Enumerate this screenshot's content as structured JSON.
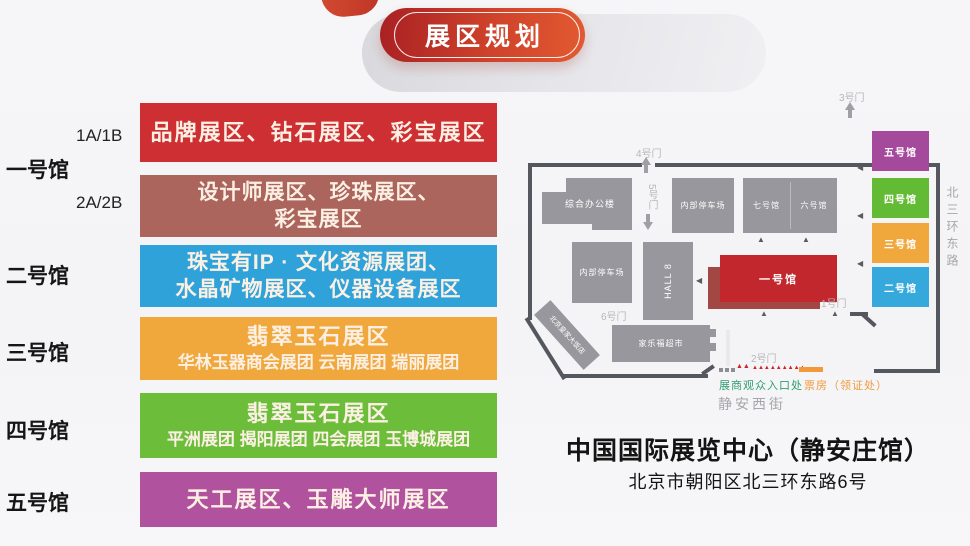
{
  "banner": {
    "title": "展区规划"
  },
  "halls": [
    {
      "name": "一号馆",
      "sub_top": "1A/1B",
      "sub_bottom": "2A/2B",
      "blocks": [
        {
          "color": "#cd2f32",
          "lines": [
            "品牌展区、钻石展区、彩宝展区"
          ]
        },
        {
          "color": "#ab655d",
          "lines": [
            "设计师展区、珍珠展区、",
            "彩宝展区"
          ]
        }
      ]
    },
    {
      "name": "二号馆",
      "blocks": [
        {
          "color": "#2fa3d9",
          "lines": [
            "珠宝有IP · 文化资源展团、",
            "水晶矿物展区、仪器设备展区"
          ]
        }
      ]
    },
    {
      "name": "三号馆",
      "blocks": [
        {
          "color": "#f0a73c",
          "title": "翡翠玉石展区",
          "sub": "华林玉器商会展团 云南展团 瑞丽展团"
        }
      ]
    },
    {
      "name": "四号馆",
      "blocks": [
        {
          "color": "#6bbd3a",
          "title": "翡翠玉石展区",
          "sub": "平洲展团 揭阳展团 四会展团 玉博城展团"
        }
      ]
    },
    {
      "name": "五号馆",
      "blocks": [
        {
          "color": "#b1529e",
          "lines": [
            "天工展区、玉雕大师展区"
          ]
        }
      ]
    }
  ],
  "map": {
    "buildings": {
      "office": "综合办公楼",
      "parking_top": "内部停车场",
      "hall7": "七号馆",
      "hall6": "六号馆",
      "parking_left": "内部停车场",
      "hall8": "HALL 8",
      "hall1": "一号馆",
      "supermarket": "家乐福超市",
      "hotel": "北京皇家大饭店"
    },
    "mini_halls": [
      {
        "label": "五号馆",
        "color": "#a4499c"
      },
      {
        "label": "四号馆",
        "color": "#63bb35"
      },
      {
        "label": "三号馆",
        "color": "#f0a73c"
      },
      {
        "label": "二号馆",
        "color": "#35a8dc"
      }
    ],
    "hall1_color": "#c1272d",
    "hall1_shadow_color": "#a34744",
    "gates": {
      "g1": "1号门",
      "g2": "2号门",
      "g3": "3号门",
      "g4": "4号门",
      "g5": "5号门",
      "g6": "6号门"
    },
    "streets": {
      "east": "北三环东路",
      "south": "静安西街"
    },
    "legend": {
      "entrance": "展商观众入口处",
      "entrance_color": "#2f9e6e",
      "ticket": "票房（领证处）",
      "ticket_color": "#f09a3c"
    }
  },
  "footer": {
    "line1": "中国国际展览中心（静安庄馆）",
    "line2": "北京市朝阳区北三环东路6号"
  },
  "colors": {
    "banner_gradient_start": "#a92023",
    "banner_gradient_end": "#e25a30",
    "building_gray": "#97979d",
    "map_border": "#54575d"
  }
}
